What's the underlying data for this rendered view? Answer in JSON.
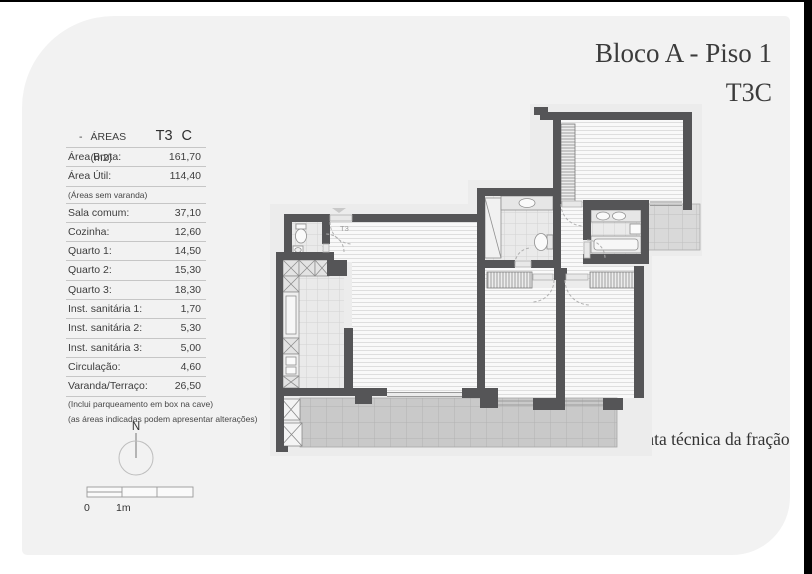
{
  "titles": {
    "line1": "Bloco A - Piso 1",
    "line2": "T3C"
  },
  "caption": "Planta técnica da fração",
  "areas_table": {
    "dash": "-",
    "header_label": "ÁREAS (m2)",
    "header_type": "T3",
    "header_variant": "C",
    "rows": [
      {
        "kind": "data",
        "label": "Área Bruta:",
        "value": "161,70"
      },
      {
        "kind": "data",
        "label": "Área Útil:",
        "value": "114,40"
      },
      {
        "kind": "note",
        "label": "(Áreas sem varanda)"
      },
      {
        "kind": "data",
        "label": "Sala comum:",
        "value": "37,10"
      },
      {
        "kind": "data",
        "label": "Cozinha:",
        "value": "12,60"
      },
      {
        "kind": "data",
        "label": "Quarto 1:",
        "value": "14,50"
      },
      {
        "kind": "data",
        "label": "Quarto 2:",
        "value": "15,30"
      },
      {
        "kind": "data",
        "label": "Quarto 3:",
        "value": "18,30"
      },
      {
        "kind": "data",
        "label": "Inst. sanitária 1:",
        "value": "1,70"
      },
      {
        "kind": "data",
        "label": "Inst. sanitária 2:",
        "value": "5,30"
      },
      {
        "kind": "data",
        "label": "Inst. sanitária 3:",
        "value": "5,00"
      },
      {
        "kind": "data",
        "label": "Circulação:",
        "value": "4,60"
      },
      {
        "kind": "data",
        "label": "Varanda/Terraço:",
        "value": "26,50"
      },
      {
        "kind": "footnote",
        "label": "(Inclui parqueamento em box na cave)"
      },
      {
        "kind": "footnote",
        "label": "(as áreas indicadas podem apresentar alterações)"
      }
    ]
  },
  "compass": {
    "north_label": "N"
  },
  "scale_bar": {
    "label_zero": "0",
    "label_one": "1m"
  },
  "floorplan": {
    "entrance_label": "T3"
  },
  "colors": {
    "wall": "#555557",
    "page": "#f2f2f2"
  }
}
